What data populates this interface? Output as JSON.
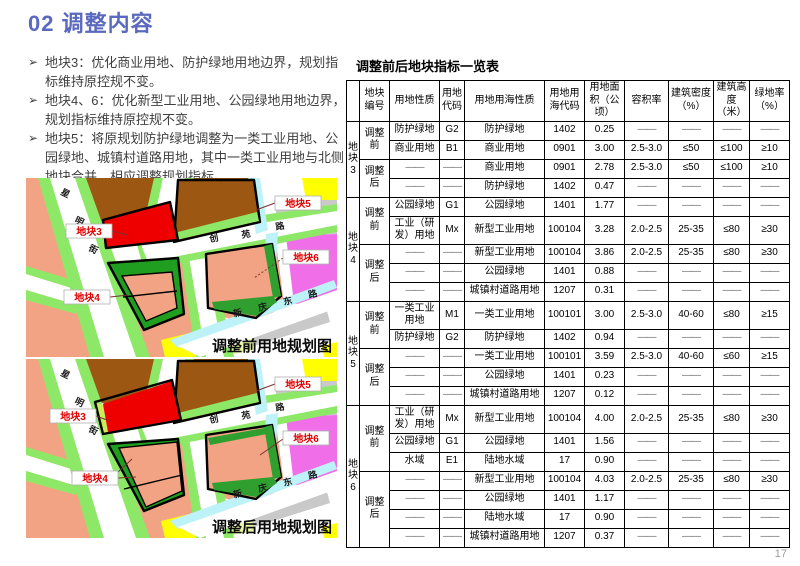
{
  "header": {
    "title": "02 调整内容"
  },
  "bullet_marker": "➢",
  "bullets": [
    "地块3：优化商业用地、防护绿地用地边界，规划指标维持原控规不变。",
    "地块4、6：优化新型工业用地、公园绿地用地边界，规划指标维持原控规不变。",
    "地块5：将原规划防护绿地调整为一类工业用地、公园绿地、城镇村道路用地，其中一类工业用地与北侧地块合并，相应调整规划指标。"
  ],
  "maps": {
    "streets": {
      "left": "星明街",
      "middle": "创苑路",
      "bottom": "新庆东路"
    },
    "plot_labels": {
      "p3": "地块3",
      "p4": "地块4",
      "p5": "地块5",
      "p6": "地块6"
    },
    "before": {
      "caption": "调整前用地规划图"
    },
    "after": {
      "caption": "调整后用地规划图"
    },
    "palette": {
      "residential_salmon": "#f2a383",
      "industrial_brown": "#9c5813",
      "commercial_red": "#ee0000",
      "protective_green": "#1f9e1f",
      "park_green": "#3cb92f",
      "roadside_green": "#8ee867",
      "water_cyan": "#bdf2f8",
      "new_industry_magenta": "#f06ee8",
      "village_yellow": "#ffff00",
      "pale_green": "#e9f7a6",
      "other_gray": "#c9c9c9"
    }
  },
  "table": {
    "title": "调整前后地块指标一览表",
    "headers": [
      "地块编号",
      "用地性质",
      "用地代码",
      "用地用海性质",
      "用地用海代码",
      "用地面积（公顷）",
      "容积率",
      "建筑密度（%）",
      "建筑高度（米）",
      "绿地率（%）"
    ],
    "blocks": [
      {
        "name": "地块3",
        "groups": [
          {
            "phase": "调整前",
            "rows": [
              [
                "防护绿地",
                "G2",
                "防护绿地",
                "1402",
                "0.25",
                "——",
                "——",
                "——",
                "——"
              ],
              [
                "商业用地",
                "B1",
                "商业用地",
                "0901",
                "3.00",
                "2.5-3.0",
                "≤50",
                "≤100",
                "≥10"
              ]
            ]
          },
          {
            "phase": "调整后",
            "rows": [
              [
                "——",
                "——",
                "商业用地",
                "0901",
                "2.78",
                "2.5-3.0",
                "≤50",
                "≤100",
                "≥10"
              ],
              [
                "——",
                "——",
                "防护绿地",
                "1402",
                "0.47",
                "——",
                "——",
                "——",
                "——"
              ]
            ]
          }
        ]
      },
      {
        "name": "地块4",
        "groups": [
          {
            "phase": "调整前",
            "rows": [
              [
                "公园绿地",
                "G1",
                "公园绿地",
                "1401",
                "1.77",
                "——",
                "——",
                "——",
                "——"
              ],
              [
                "工业（研发）用地",
                "Mx",
                "新型工业用地",
                "100104",
                "3.28",
                "2.0-2.5",
                "25-35",
                "≤80",
                "≥30"
              ]
            ]
          },
          {
            "phase": "调整后",
            "rows": [
              [
                "——",
                "——",
                "新型工业用地",
                "100104",
                "3.86",
                "2.0-2.5",
                "25-35",
                "≤80",
                "≥30"
              ],
              [
                "——",
                "——",
                "公园绿地",
                "1401",
                "0.88",
                "——",
                "——",
                "——",
                "——"
              ],
              [
                "——",
                "——",
                "城镇村道路用地",
                "1207",
                "0.31",
                "——",
                "——",
                "——",
                "——"
              ]
            ]
          }
        ]
      },
      {
        "name": "地块5",
        "groups": [
          {
            "phase": "调整前",
            "rows": [
              [
                "一类工业用地",
                "M1",
                "一类工业用地",
                "100101",
                "3.00",
                "2.5-3.0",
                "40-60",
                "≤80",
                "≥15"
              ],
              [
                "防护绿地",
                "G2",
                "防护绿地",
                "1402",
                "0.94",
                "——",
                "——",
                "——",
                "——"
              ]
            ]
          },
          {
            "phase": "调整后",
            "rows": [
              [
                "——",
                "——",
                "一类工业用地",
                "100101",
                "3.59",
                "2.5-3.0",
                "40-60",
                "≤60",
                "≥15"
              ],
              [
                "——",
                "——",
                "公园绿地",
                "1401",
                "0.23",
                "——",
                "——",
                "——",
                "——"
              ],
              [
                "——",
                "——",
                "城镇村道路用地",
                "1207",
                "0.12",
                "——",
                "——",
                "——",
                "——"
              ]
            ]
          }
        ]
      },
      {
        "name": "地块6",
        "groups": [
          {
            "phase": "调整前",
            "rows": [
              [
                "工业（研发）用地",
                "Mx",
                "新型工业用地",
                "100104",
                "4.00",
                "2.0-2.5",
                "25-35",
                "≤80",
                "≥30"
              ],
              [
                "公园绿地",
                "G1",
                "公园绿地",
                "1401",
                "1.56",
                "——",
                "——",
                "——",
                "——"
              ],
              [
                "水域",
                "E1",
                "陆地水域",
                "17",
                "0.90",
                "——",
                "——",
                "——",
                "——"
              ]
            ]
          },
          {
            "phase": "调整后",
            "rows": [
              [
                "——",
                "——",
                "新型工业用地",
                "100104",
                "4.03",
                "2.0-2.5",
                "25-35",
                "≤80",
                "≥30"
              ],
              [
                "——",
                "——",
                "公园绿地",
                "1401",
                "1.17",
                "——",
                "——",
                "——",
                "——"
              ],
              [
                "——",
                "——",
                "陆地水域",
                "17",
                "0.90",
                "——",
                "——",
                "——",
                "——"
              ],
              [
                "——",
                "——",
                "城镇村道路用地",
                "1207",
                "0.37",
                "——",
                "——",
                "——",
                "——"
              ]
            ]
          }
        ]
      }
    ]
  },
  "page": {
    "number": "17"
  }
}
